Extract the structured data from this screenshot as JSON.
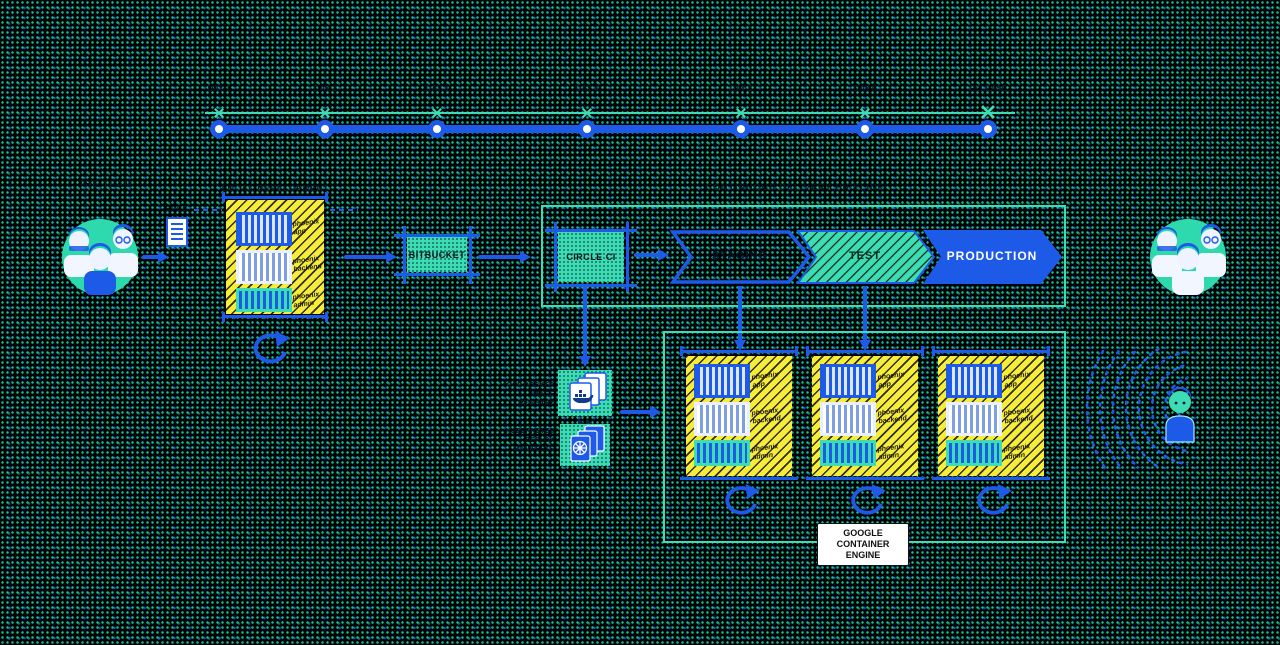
{
  "labels": {
    "team_left": "THE TEAM",
    "spec_doc": "SPEC",
    "local_env": "LOCAL DEVELOPMENT",
    "pipeline_title": "CONTINUOUS DELIVERY PIPELINE",
    "registry_docker": [
      "GCP DOCKER",
      "IMAGE",
      "REGISTRY"
    ],
    "registry_k8s": [
      "KUBERNETES",
      "DEPLOY",
      "MANIFESTS"
    ]
  },
  "timeline": {
    "day_labels": [
      "DAY 1",
      "DAY 2",
      "DAY 3",
      "DAY 4",
      "DAY 5",
      "DAY 6",
      "RELEASE"
    ]
  },
  "services": {
    "bitbucket": "BITBUCKET",
    "circleci": "CIRCLE CI"
  },
  "stages": {
    "staging": "STAGING",
    "test": "TEST",
    "production": "PRODUCTION"
  },
  "stack": {
    "app": "phoenix app",
    "backend": "phoenix backend",
    "admin": "phoenix admin"
  },
  "gke": {
    "label": "GOOGLE CONTAINER ENGINE"
  },
  "colors": {
    "blue": "#1e5ae8",
    "teal": "#3cdcb4",
    "yellow": "#f8ec3a",
    "background": "#000107"
  }
}
